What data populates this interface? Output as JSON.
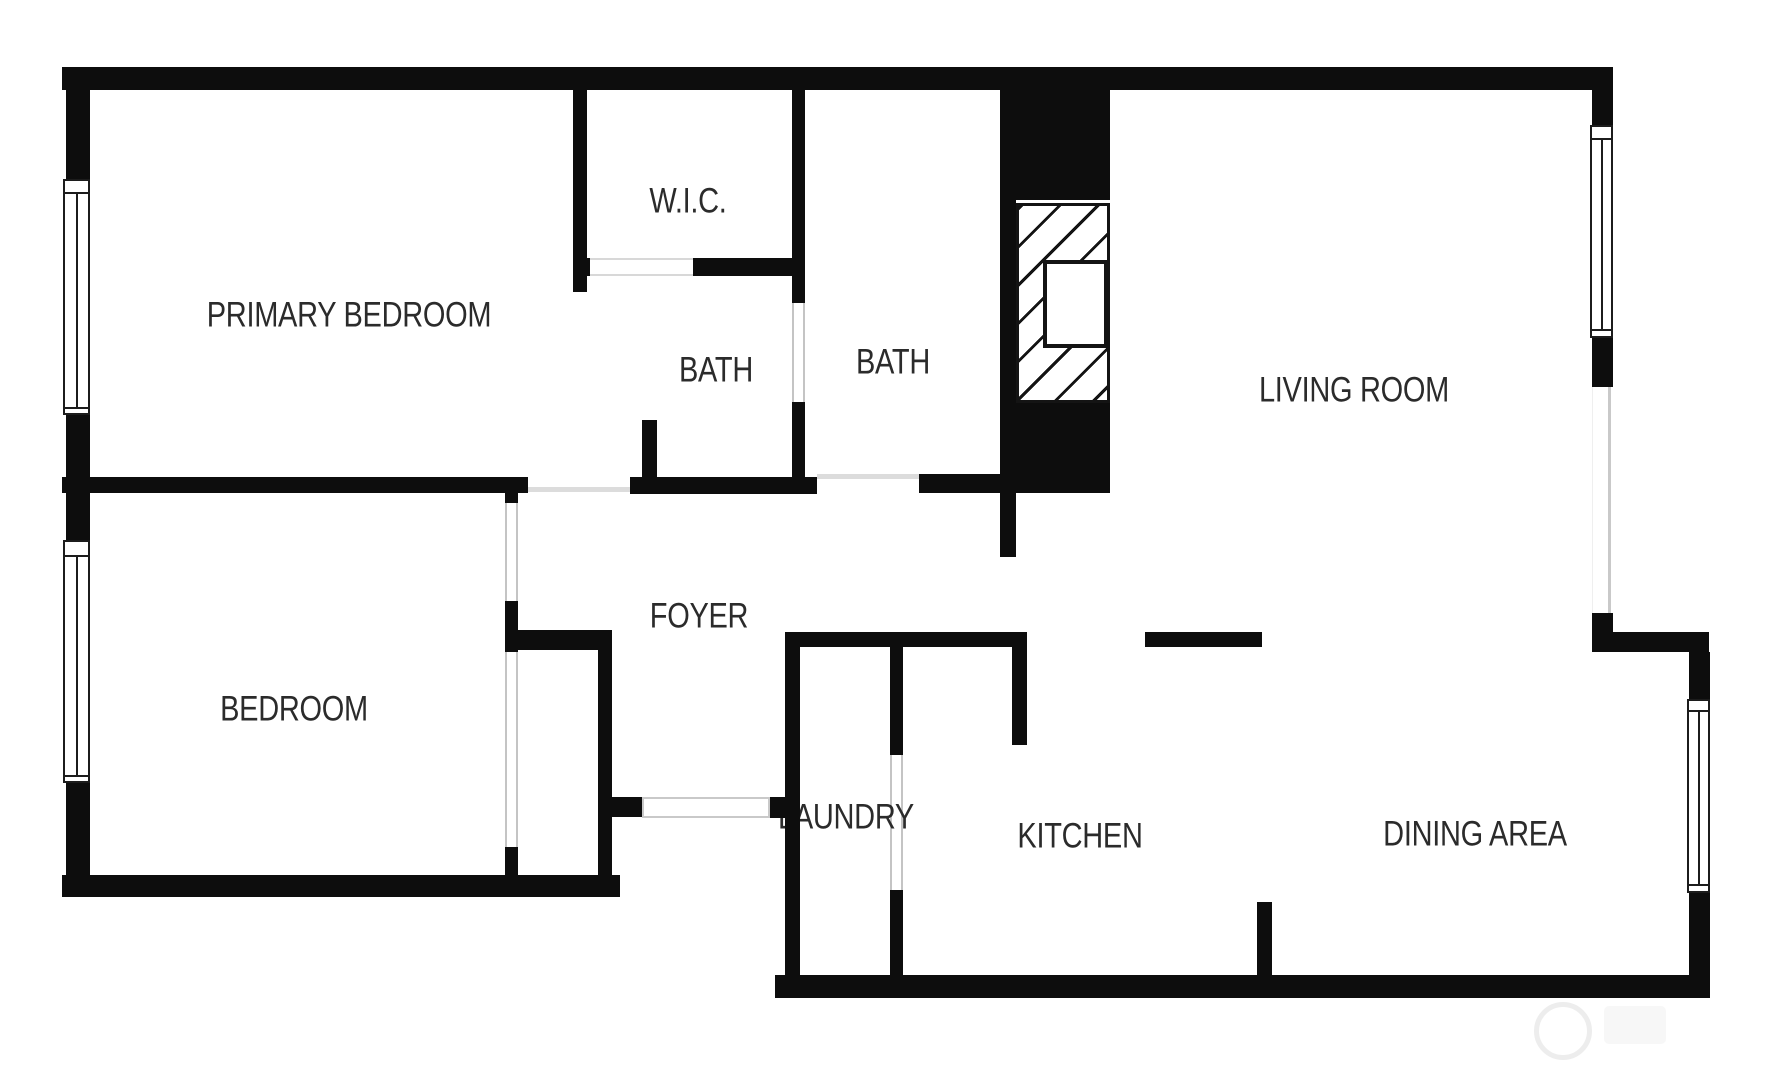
{
  "plan": {
    "title": "2 bed 2 bath apartment floor plan",
    "background": "#ffffff",
    "wall_color": "#0d0d0d",
    "text_color": "#2b2b2b",
    "opening_color": "#c4c4c4"
  },
  "rooms": [
    {
      "id": "primary-bedroom",
      "label": "PRIMARY BEDROOM",
      "cx": 349,
      "cy": 316
    },
    {
      "id": "wic",
      "label": "W.I.C.",
      "cx": 688,
      "cy": 202
    },
    {
      "id": "bath-1",
      "label": "BATH",
      "cx": 716,
      "cy": 371
    },
    {
      "id": "bath-2",
      "label": "BATH",
      "cx": 893,
      "cy": 363
    },
    {
      "id": "living-room",
      "label": "LIVING ROOM",
      "cx": 1354,
      "cy": 391
    },
    {
      "id": "bedroom",
      "label": "BEDROOM",
      "cx": 294,
      "cy": 710
    },
    {
      "id": "foyer",
      "label": "FOYER",
      "cx": 699,
      "cy": 617
    },
    {
      "id": "laundry",
      "label": "LAUNDRY",
      "cx": 846,
      "cy": 818
    },
    {
      "id": "kitchen",
      "label": "KITCHEN",
      "cx": 1080,
      "cy": 837
    },
    {
      "id": "dining-area",
      "label": "DINING AREA",
      "cx": 1475,
      "cy": 835
    }
  ],
  "geometry": {
    "walls": [
      {
        "name": "top-exterior-wall",
        "x": 62,
        "y": 67,
        "w": 1551,
        "h": 23
      },
      {
        "name": "left-exterior-wall-upper",
        "x": 66,
        "y": 67,
        "w": 24,
        "h": 112
      },
      {
        "name": "left-exterior-wall-mid",
        "x": 66,
        "y": 415,
        "w": 24,
        "h": 125
      },
      {
        "name": "left-exterior-wall-lower",
        "x": 66,
        "y": 783,
        "w": 24,
        "h": 114
      },
      {
        "name": "bedroom-bottom-wall",
        "x": 62,
        "y": 875,
        "w": 558,
        "h": 22
      },
      {
        "name": "living-right-wall-a",
        "x": 1592,
        "y": 90,
        "w": 21,
        "h": 35
      },
      {
        "name": "living-right-wall-b",
        "x": 1592,
        "y": 338,
        "w": 21,
        "h": 49
      },
      {
        "name": "living-right-wall-c",
        "x": 1592,
        "y": 613,
        "w": 21,
        "h": 39
      },
      {
        "name": "dining-step-wall",
        "x": 1613,
        "y": 632,
        "w": 96,
        "h": 20
      },
      {
        "name": "dining-right-wall-a",
        "x": 1689,
        "y": 652,
        "w": 21,
        "h": 47
      },
      {
        "name": "dining-right-wall-b",
        "x": 1689,
        "y": 893,
        "w": 21,
        "h": 105
      },
      {
        "name": "bottom-exterior-wall",
        "x": 775,
        "y": 975,
        "w": 935,
        "h": 23
      },
      {
        "name": "wic-left-wall",
        "x": 573,
        "y": 90,
        "w": 14,
        "h": 202
      },
      {
        "name": "wic-bottom-wall-left",
        "x": 573,
        "y": 258,
        "w": 17,
        "h": 18
      },
      {
        "name": "wic-bottom-wall-right",
        "x": 693,
        "y": 258,
        "w": 112,
        "h": 18
      },
      {
        "name": "bath-divider-wall-upper",
        "x": 792,
        "y": 90,
        "w": 13,
        "h": 213
      },
      {
        "name": "bath-divider-wall-lower",
        "x": 792,
        "y": 402,
        "w": 13,
        "h": 91
      },
      {
        "name": "bath-bottom-wall-left",
        "x": 630,
        "y": 477,
        "w": 187,
        "h": 17
      },
      {
        "name": "bath-stub-wall",
        "x": 642,
        "y": 420,
        "w": 15,
        "h": 57
      },
      {
        "name": "bath-bottom-wall-right",
        "x": 919,
        "y": 474,
        "w": 191,
        "h": 19
      },
      {
        "name": "chimney-top-block",
        "x": 1000,
        "y": 88,
        "w": 110,
        "h": 112
      },
      {
        "name": "chimney-left-wall",
        "x": 1000,
        "y": 88,
        "w": 16,
        "h": 390
      },
      {
        "name": "chimney-bottom-block",
        "x": 1000,
        "y": 403,
        "w": 110,
        "h": 74
      },
      {
        "name": "foyer-living-stub",
        "x": 1000,
        "y": 493,
        "w": 16,
        "h": 64
      },
      {
        "name": "bedrooms-divider-wall",
        "x": 62,
        "y": 477,
        "w": 466,
        "h": 16
      },
      {
        "name": "bedroom-door-jamb-top",
        "x": 505,
        "y": 493,
        "w": 13,
        "h": 10
      },
      {
        "name": "bedroom-door-jamb-bottom",
        "x": 505,
        "y": 601,
        "w": 13,
        "h": 51
      },
      {
        "name": "closet-top-wall",
        "x": 518,
        "y": 630,
        "w": 94,
        "h": 20
      },
      {
        "name": "bedroom-right-wall",
        "x": 598,
        "y": 630,
        "w": 14,
        "h": 248
      },
      {
        "name": "closet-bottom-stub",
        "x": 505,
        "y": 847,
        "w": 13,
        "h": 30
      },
      {
        "name": "entry-jamb-stub",
        "x": 612,
        "y": 797,
        "w": 30,
        "h": 20
      },
      {
        "name": "entry-jamb-bump",
        "x": 770,
        "y": 797,
        "w": 18,
        "h": 21
      },
      {
        "name": "laundry-left-wall",
        "x": 785,
        "y": 632,
        "w": 15,
        "h": 365
      },
      {
        "name": "foyer-kitchen-top-wall",
        "x": 785,
        "y": 632,
        "w": 242,
        "h": 15
      },
      {
        "name": "laundry-right-wall-upper",
        "x": 890,
        "y": 647,
        "w": 13,
        "h": 108
      },
      {
        "name": "laundry-right-wall-lower",
        "x": 890,
        "y": 890,
        "w": 13,
        "h": 107
      },
      {
        "name": "kitchen-entry-wall",
        "x": 1012,
        "y": 647,
        "w": 15,
        "h": 98
      },
      {
        "name": "foyer-divider-bar",
        "x": 1145,
        "y": 632,
        "w": 117,
        "h": 15
      },
      {
        "name": "kitchen-dining-stub",
        "x": 1257,
        "y": 902,
        "w": 15,
        "h": 76
      }
    ],
    "windows": [
      {
        "name": "primary-bedroom-window",
        "x": 63,
        "y": 179,
        "w": 27,
        "h": 236,
        "g1": 11,
        "g2": 226
      },
      {
        "name": "bedroom-window",
        "x": 63,
        "y": 540,
        "w": 27,
        "h": 243,
        "g1": 13,
        "g2": 233
      },
      {
        "name": "living-room-window",
        "x": 1590,
        "y": 125,
        "w": 23,
        "h": 213,
        "g1": 11,
        "g2": 202
      },
      {
        "name": "dining-area-window",
        "x": 1687,
        "y": 699,
        "w": 23,
        "h": 194,
        "g1": 9,
        "g2": 183
      }
    ],
    "openings": [
      {
        "name": "bedroom-door-opening",
        "x": 505,
        "y": 503,
        "w": 13,
        "h": 98,
        "kind": "lr"
      },
      {
        "name": "closet-sliding-door",
        "x": 505,
        "y": 652,
        "w": 13,
        "h": 195,
        "kind": "lr"
      },
      {
        "name": "bath-divider-door-opening",
        "x": 792,
        "y": 303,
        "w": 13,
        "h": 99,
        "kind": "lr"
      },
      {
        "name": "wic-door-opening",
        "x": 590,
        "y": 258,
        "w": 103,
        "h": 18,
        "kind": "tb"
      },
      {
        "name": "primary-bedroom-entry-line",
        "x": 528,
        "y": 487,
        "w": 102,
        "h": 5,
        "kind": "line"
      },
      {
        "name": "bath-entry-line",
        "x": 817,
        "y": 474,
        "w": 102,
        "h": 5,
        "kind": "line"
      },
      {
        "name": "main-entry-door",
        "x": 642,
        "y": 797,
        "w": 128,
        "h": 21,
        "kind": "box"
      },
      {
        "name": "laundry-door-opening",
        "x": 890,
        "y": 755,
        "w": 13,
        "h": 135,
        "kind": "lr"
      },
      {
        "name": "living-room-side-opening",
        "x": 1592,
        "y": 387,
        "w": 19,
        "h": 226,
        "kind": "r"
      }
    ],
    "fireplace": {
      "x": 1016,
      "y": 203,
      "w": 94,
      "h": 200,
      "insert": {
        "x": 1043,
        "y": 260,
        "w": 65,
        "h": 88
      }
    },
    "watermark": {
      "ring": {
        "cx": 1558,
        "cy": 1026,
        "r": 24
      },
      "blob": {
        "x": 1604,
        "y": 1006,
        "w": 62,
        "h": 38
      }
    }
  }
}
